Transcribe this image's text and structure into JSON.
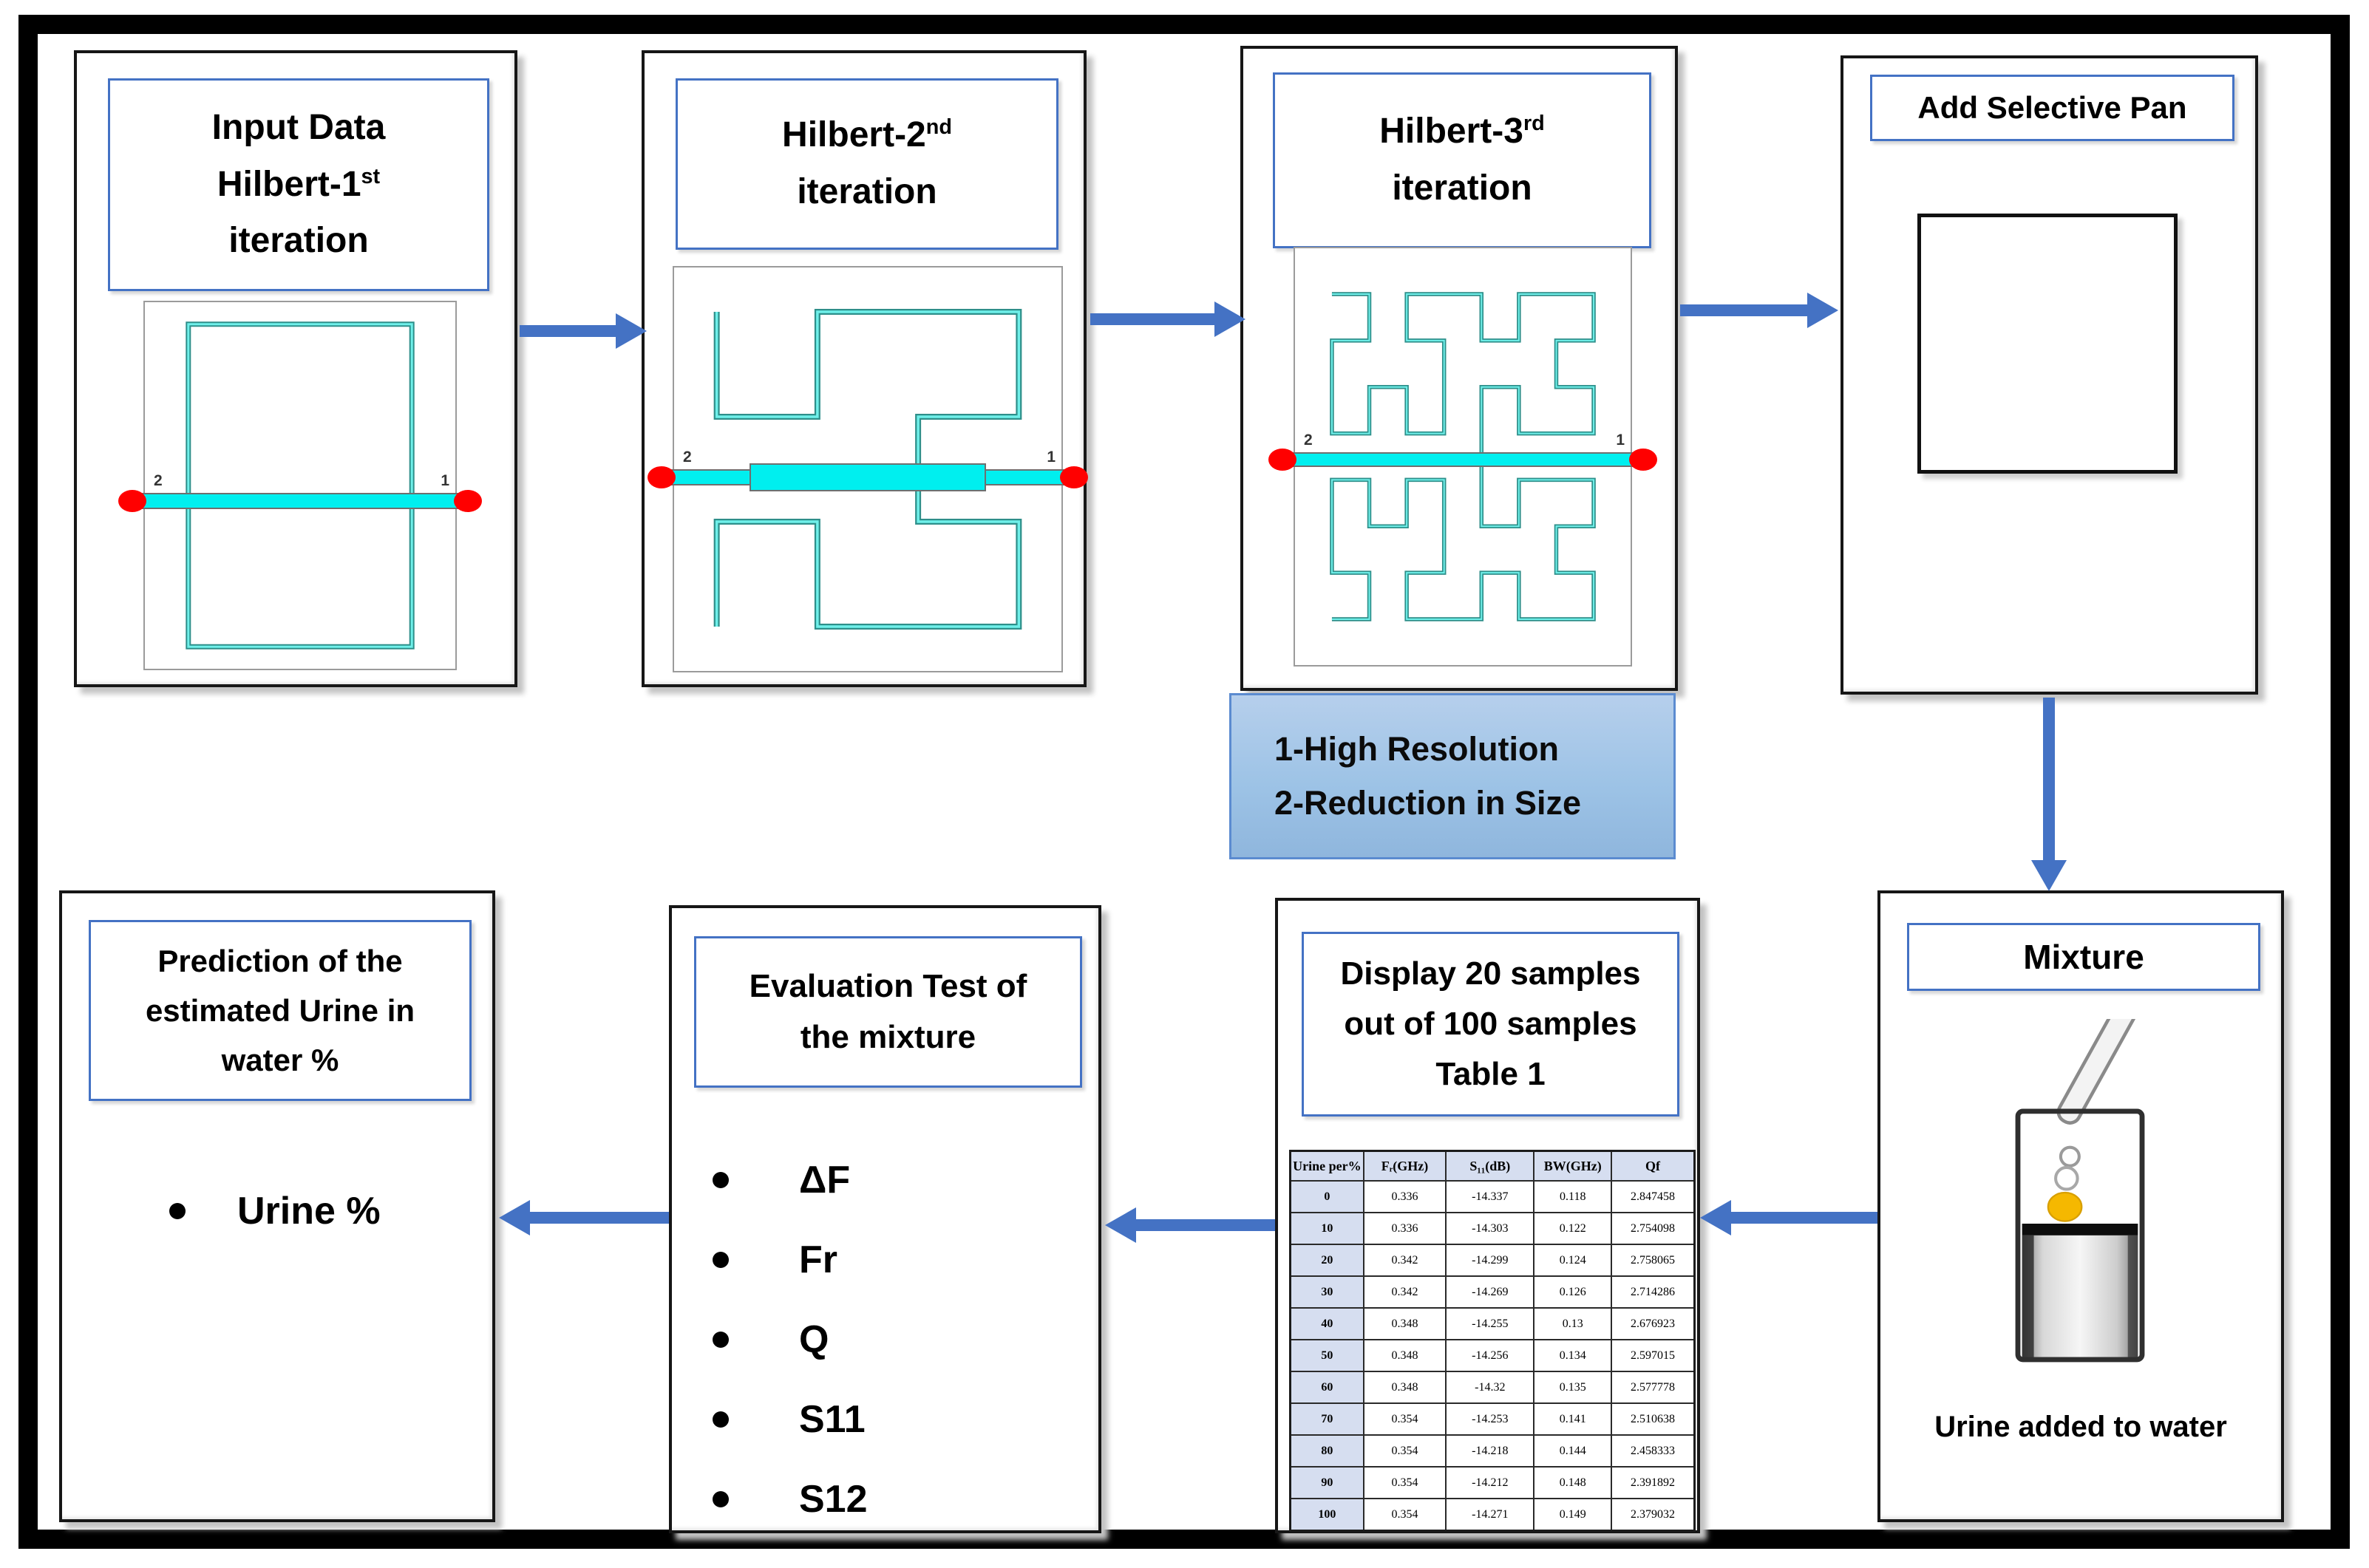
{
  "steps": {
    "step1": {
      "title_line1": "Input Data",
      "title_base": "Hilbert-1",
      "title_sup": "st",
      "title_line3": "iteration",
      "port_left": "2",
      "port_right": "1"
    },
    "step2": {
      "title_base": "Hilbert-2",
      "title_sup": "nd",
      "title_line2": "iteration",
      "port_left": "2",
      "port_right": "1"
    },
    "step3": {
      "title_base": "Hilbert-3",
      "title_sup": "rd",
      "title_line2": "iteration",
      "port_left": "2",
      "port_right": "1",
      "note_line1": "1-High Resolution",
      "note_line2": "2-Reduction in Size"
    },
    "step4": {
      "title": "Add Selective Pan"
    },
    "mixture": {
      "title": "Mixture",
      "caption": "Urine added to water"
    },
    "samples": {
      "title_line1": "Display 20 samples",
      "title_line2": "out of 100 samples",
      "title_line3": "Table 1"
    },
    "evaluation": {
      "title_line1": "Evaluation Test of",
      "title_line2": "the mixture",
      "items": [
        "ΔF",
        "Fr",
        "Q",
        "S11",
        "S12"
      ]
    },
    "prediction": {
      "title_line1": "Prediction of the",
      "title_line2": "estimated Urine in",
      "title_line3": "water %",
      "item": "Urine %"
    }
  },
  "table": {
    "headers": [
      "Urine per%",
      "Fᵣ(GHz)",
      "S₁₁(dB)",
      "BW(GHz)",
      "Qf"
    ],
    "rows": [
      [
        "0",
        "0.336",
        "-14.337",
        "0.118",
        "2.847458"
      ],
      [
        "10",
        "0.336",
        "-14.303",
        "0.122",
        "2.754098"
      ],
      [
        "20",
        "0.342",
        "-14.299",
        "0.124",
        "2.758065"
      ],
      [
        "30",
        "0.342",
        "-14.269",
        "0.126",
        "2.714286"
      ],
      [
        "40",
        "0.348",
        "-14.255",
        "0.13",
        "2.676923"
      ],
      [
        "50",
        "0.348",
        "-14.256",
        "0.134",
        "2.597015"
      ],
      [
        "60",
        "0.348",
        "-14.32",
        "0.135",
        "2.577778"
      ],
      [
        "70",
        "0.354",
        "-14.253",
        "0.141",
        "2.510638"
      ],
      [
        "80",
        "0.354",
        "-14.218",
        "0.144",
        "2.458333"
      ],
      [
        "90",
        "0.354",
        "-14.212",
        "0.148",
        "2.391892"
      ],
      [
        "100",
        "0.354",
        "-14.271",
        "0.149",
        "2.379032"
      ]
    ]
  },
  "colors": {
    "arrow_blue": "#4472C4",
    "accent_border_blue": "#4472C4",
    "note_fill_blue": "#9DC3E6",
    "trace_teal": "#20B2AA",
    "feed_cyan": "#00EFEF",
    "port_red": "#FF0000",
    "table_band_blue": "#D6DEF0",
    "drop_yellow": "#F5B800"
  }
}
